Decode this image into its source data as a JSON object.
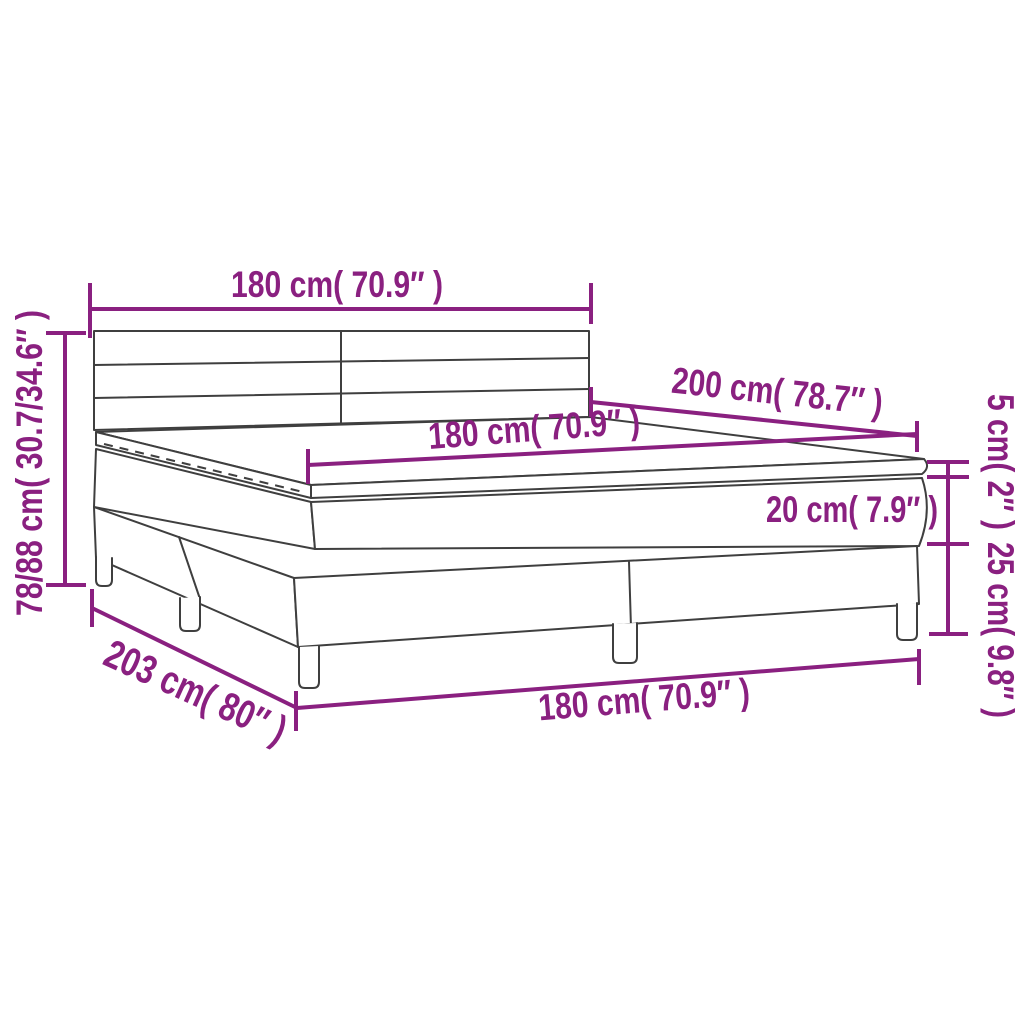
{
  "diagram": {
    "kind": "product-dimension-diagram",
    "subject": "box spring bed with headboard, mattress and topper",
    "accent_color": "#8a2080",
    "line_color": "#3f3f3f",
    "background_color": "#ffffff",
    "labels": {
      "headboard_width": "180 cm( 70.9″ )",
      "mattress_width": "180 cm( 70.9″ )",
      "bed_length": "200 cm( 78.7″ )",
      "topper_thickness": "5 cm( 2″ )",
      "mattress_thickness": "20 cm( 7.9″ )",
      "base_height": "25 cm( 9.8″ )",
      "total_height": "78/88 cm( 30.7/34.6″ )",
      "total_length": "203 cm( 80″ )",
      "base_width": "180 cm( 70.9″ )"
    }
  }
}
